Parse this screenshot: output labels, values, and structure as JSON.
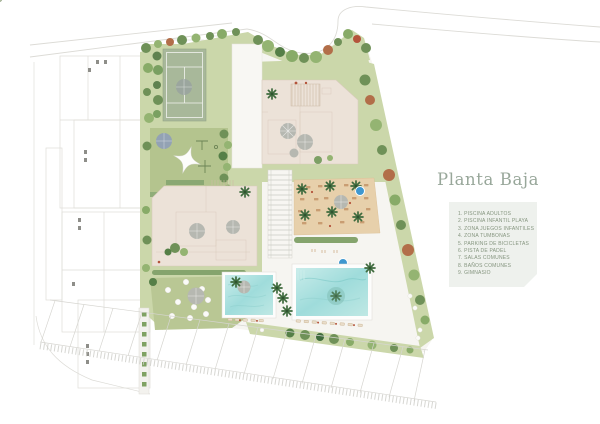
{
  "panel": {
    "title": "Planta Baja",
    "legend_items": [
      "1. PISCINA ADULTOS",
      "2. PISCINA INFANTIL PLAYA",
      "3. ZONA JUEGOS INFANTILES",
      "4. ZONA TUMBONAS",
      "5. PARKING DE BICICLETAS",
      "6. PISTA DE PADEL",
      "7. SALAS COMUNES",
      "8. BAÑOS COMUNES",
      "9. GIMNASIO"
    ]
  },
  "colors": {
    "title_text": "#98a79a",
    "legend_box_bg": "#eef1ed",
    "legend_text": "#84947e",
    "lawn": "#cbd7aa",
    "playground_lawn": "#b4c48e",
    "padel_court": "#a8b89a",
    "building": "#ece2d8",
    "pool_water": "#9fdcdb",
    "deck": "#e7d0ab",
    "tree_green": "#6f9158",
    "tree_rust": "#b26e49",
    "spa_blue": "#3e97cf"
  }
}
